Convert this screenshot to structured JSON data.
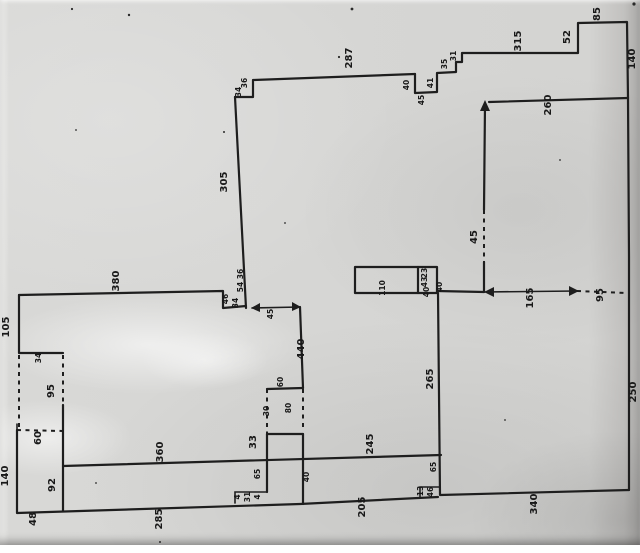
{
  "meta": {
    "description": "Scanned photocopy of a hand-drawn floor-plan / survey sketch with handwritten dimension numbers (all numerals written rotated 90° counter-clockwise)",
    "paper_color": "#d4d4d2",
    "ink_color": "#1e1e1e"
  },
  "dimension_labels": [
    {
      "text": "305",
      "x": 227,
      "y": 182,
      "size": "m"
    },
    {
      "text": "36",
      "x": 247,
      "y": 83,
      "size": "s"
    },
    {
      "text": "34",
      "x": 241,
      "y": 92,
      "size": "s"
    },
    {
      "text": "287",
      "x": 352,
      "y": 58,
      "size": "m"
    },
    {
      "text": "40",
      "x": 409,
      "y": 85,
      "size": "s"
    },
    {
      "text": "45",
      "x": 424,
      "y": 100,
      "size": "s"
    },
    {
      "text": "41",
      "x": 433,
      "y": 83,
      "size": "s"
    },
    {
      "text": "35",
      "x": 447,
      "y": 64,
      "size": "s"
    },
    {
      "text": "31",
      "x": 456,
      "y": 56,
      "size": "s"
    },
    {
      "text": "315",
      "x": 521,
      "y": 41,
      "size": "m"
    },
    {
      "text": "52",
      "x": 570,
      "y": 37,
      "size": "m"
    },
    {
      "text": "85",
      "x": 600,
      "y": 14,
      "size": "m"
    },
    {
      "text": "140",
      "x": 635,
      "y": 59,
      "size": "m"
    },
    {
      "text": "260",
      "x": 551,
      "y": 105,
      "size": "m"
    },
    {
      "text": "45",
      "x": 477,
      "y": 237,
      "size": "m"
    },
    {
      "text": "165",
      "x": 533,
      "y": 298,
      "size": "m"
    },
    {
      "text": "95",
      "x": 603,
      "y": 295,
      "size": "m"
    },
    {
      "text": "250",
      "x": 636,
      "y": 392,
      "size": "m"
    },
    {
      "text": "340",
      "x": 537,
      "y": 504,
      "size": "m"
    },
    {
      "text": "265",
      "x": 433,
      "y": 379,
      "size": "m"
    },
    {
      "text": "110",
      "x": 385,
      "y": 288,
      "size": "s"
    },
    {
      "text": "23",
      "x": 427,
      "y": 273,
      "size": "s"
    },
    {
      "text": "43",
      "x": 427,
      "y": 282,
      "size": "s"
    },
    {
      "text": "40",
      "x": 429,
      "y": 292,
      "size": "s"
    },
    {
      "text": "40",
      "x": 442,
      "y": 287,
      "size": "s"
    },
    {
      "text": "380",
      "x": 119,
      "y": 281,
      "size": "m"
    },
    {
      "text": "36",
      "x": 243,
      "y": 274,
      "size": "s"
    },
    {
      "text": "54",
      "x": 243,
      "y": 287,
      "size": "s"
    },
    {
      "text": "46",
      "x": 228,
      "y": 299,
      "size": "s"
    },
    {
      "text": "34",
      "x": 238,
      "y": 303,
      "size": "s"
    },
    {
      "text": "45",
      "x": 273,
      "y": 314,
      "size": "s"
    },
    {
      "text": "440",
      "x": 304,
      "y": 349,
      "size": "m"
    },
    {
      "text": "60",
      "x": 283,
      "y": 382,
      "size": "s"
    },
    {
      "text": "30",
      "x": 269,
      "y": 411,
      "size": "s"
    },
    {
      "text": "80",
      "x": 291,
      "y": 408,
      "size": "s"
    },
    {
      "text": "33",
      "x": 256,
      "y": 442,
      "size": "m"
    },
    {
      "text": "105",
      "x": 9,
      "y": 327,
      "size": "m"
    },
    {
      "text": "34",
      "x": 41,
      "y": 358,
      "size": "s"
    },
    {
      "text": "95",
      "x": 54,
      "y": 391,
      "size": "m"
    },
    {
      "text": "60",
      "x": 41,
      "y": 438,
      "size": "m"
    },
    {
      "text": "140",
      "x": 8,
      "y": 476,
      "size": "m"
    },
    {
      "text": "92",
      "x": 55,
      "y": 485,
      "size": "m"
    },
    {
      "text": "48",
      "x": 36,
      "y": 519,
      "size": "m"
    },
    {
      "text": "360",
      "x": 163,
      "y": 452,
      "size": "m"
    },
    {
      "text": "245",
      "x": 373,
      "y": 444,
      "size": "m"
    },
    {
      "text": "65",
      "x": 260,
      "y": 474,
      "size": "s"
    },
    {
      "text": "40",
      "x": 309,
      "y": 477,
      "size": "s"
    },
    {
      "text": "65",
      "x": 436,
      "y": 467,
      "size": "s"
    },
    {
      "text": "285",
      "x": 162,
      "y": 519,
      "size": "m"
    },
    {
      "text": "205",
      "x": 365,
      "y": 507,
      "size": "m"
    },
    {
      "text": "13",
      "x": 423,
      "y": 491,
      "size": "s"
    },
    {
      "text": "46",
      "x": 433,
      "y": 492,
      "size": "s"
    },
    {
      "text": "4",
      "x": 240,
      "y": 497,
      "size": "s"
    },
    {
      "text": "31",
      "x": 250,
      "y": 497,
      "size": "s"
    },
    {
      "text": "4",
      "x": 260,
      "y": 497,
      "size": "s"
    }
  ]
}
